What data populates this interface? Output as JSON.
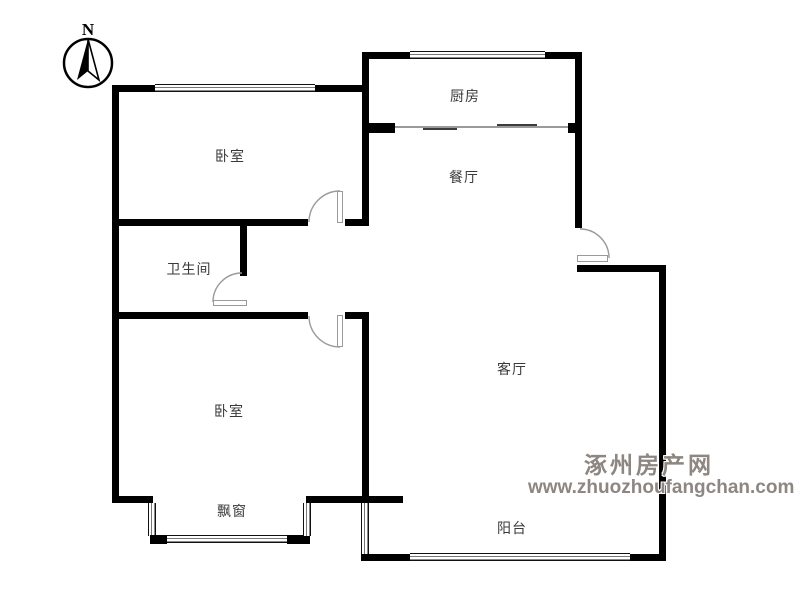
{
  "compass": {
    "label": "N"
  },
  "rooms": [
    {
      "id": "kitchen",
      "label": "厨房"
    },
    {
      "id": "dining",
      "label": "餐厅"
    },
    {
      "id": "bedroom-top",
      "label": "卧室"
    },
    {
      "id": "bathroom",
      "label": "卫生间"
    },
    {
      "id": "living",
      "label": "客厅"
    },
    {
      "id": "bedroom-bottom",
      "label": "卧室"
    },
    {
      "id": "bay-window",
      "label": "飘窗"
    },
    {
      "id": "balcony",
      "label": "阳台"
    }
  ],
  "watermark": {
    "site_name": "涿州房产网",
    "site_url": "www.zhuozhoufangchan.com",
    "color": "#8d8681"
  },
  "colors": {
    "wall": "#000000",
    "door_line": "#9a9a9a",
    "background": "#ffffff"
  }
}
